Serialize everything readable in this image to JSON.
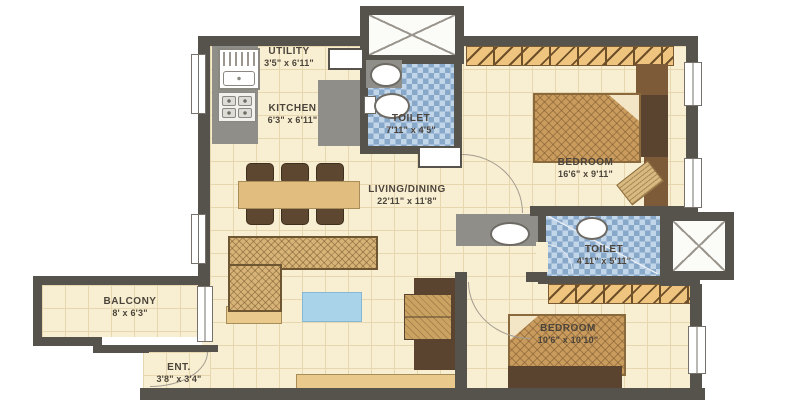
{
  "plan": {
    "type": "apartment-floor-plan",
    "rooms": {
      "utility": {
        "label": "UTILITY",
        "dims": "3'5\" x 6'11\""
      },
      "kitchen": {
        "label": "KITCHEN",
        "dims": "6'3\" x 6'11\""
      },
      "toilet1": {
        "label": "TOILET",
        "dims": "7'11\" x 4'5\""
      },
      "bedroom1": {
        "label": "BEDROOM",
        "dims": "16'6\" x 9'11\""
      },
      "living": {
        "label": "LIVING/DINING",
        "dims": "22'11\" x 11'8\""
      },
      "toilet2": {
        "label": "TOILET",
        "dims": "4'11\" x 5'11\""
      },
      "balcony": {
        "label": "BALCONY",
        "dims": "8' x 6'3\""
      },
      "bedroom2": {
        "label": "BEDROOM",
        "dims": "10'6\" x 10'10\""
      },
      "entry": {
        "label": "ENT.",
        "dims": "3'8\" x 3'4\""
      }
    },
    "palette": {
      "wall": "#56524c",
      "floor": "#f8efd2",
      "floor_grid": "#e7d7ae",
      "toilet_tile_dark": "#88a8ca",
      "toilet_tile_light": "#c2d6ea",
      "wardrobe_hatch": "#efc47e",
      "wood_dark": "#5a432f",
      "wood_mid": "#7d5a38",
      "bed": "#c99c5e",
      "coffee_table_blue": "#a9d3e8",
      "counter_gray": "#908e89",
      "label_text": "#4c443a"
    }
  }
}
